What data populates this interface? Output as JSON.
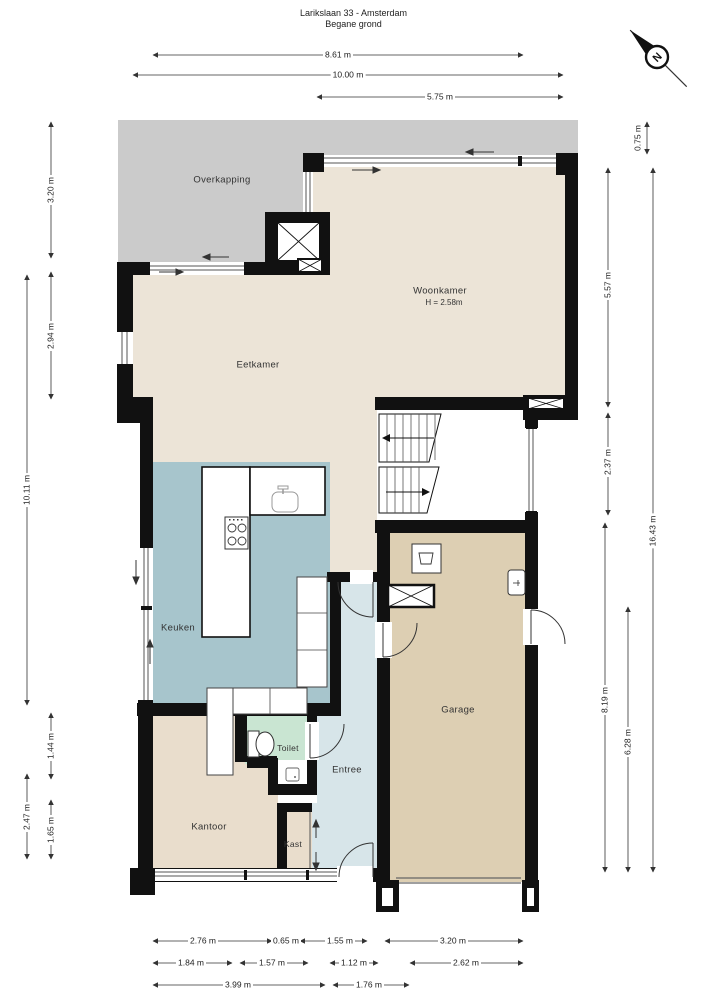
{
  "title": {
    "line1": "Larikslaan 33 - Amsterdam",
    "line2": "Begane grond"
  },
  "compass": {
    "label": "N"
  },
  "rooms": {
    "overkapping": {
      "label": "Overkapping"
    },
    "woonkamer": {
      "label": "Woonkamer",
      "height_note": "H = 2.58m"
    },
    "eetkamer": {
      "label": "Eetkamer"
    },
    "keuken": {
      "label": "Keuken"
    },
    "toilet": {
      "label": "Toilet"
    },
    "entree": {
      "label": "Entree"
    },
    "kantoor": {
      "label": "Kantoor"
    },
    "kast": {
      "label": "Kast"
    },
    "garage": {
      "label": "Garage"
    }
  },
  "dimensions": {
    "top": {
      "d1": "8.61 m",
      "d2": "10.00 m",
      "d3": "5.75 m"
    },
    "left": {
      "d1": "3.20 m",
      "d2": "2.94 m",
      "d3": "10.11 m",
      "d4": "1.44 m",
      "d5": "2.47 m",
      "d6": "1.65 m"
    },
    "right": {
      "d1": "0.75 m",
      "d2": "5.57 m",
      "d3": "2.37 m",
      "d4": "8.19 m",
      "d5": "6.28 m",
      "d6": "16.43 m"
    },
    "bottom_row1": {
      "d1": "2.76 m",
      "d2": "0.65 m",
      "d3": "1.55 m",
      "d4": "3.20 m"
    },
    "bottom_row2": {
      "d1": "1.84 m",
      "d2": "1.57 m",
      "d3": "1.12 m",
      "d4": "2.62 m"
    },
    "bottom_row3": {
      "d1": "3.99 m",
      "d2": "1.76 m"
    }
  },
  "colors": {
    "wall": "#111111",
    "floor": "#ece4d7",
    "overkapping": "#cbcbcb",
    "keuken": "#a7c5cc",
    "entree": "#d7e5e9",
    "toilet": "#c9e5d2",
    "garage": "#ddcfb3",
    "kantoor": "#e9ddcc"
  }
}
